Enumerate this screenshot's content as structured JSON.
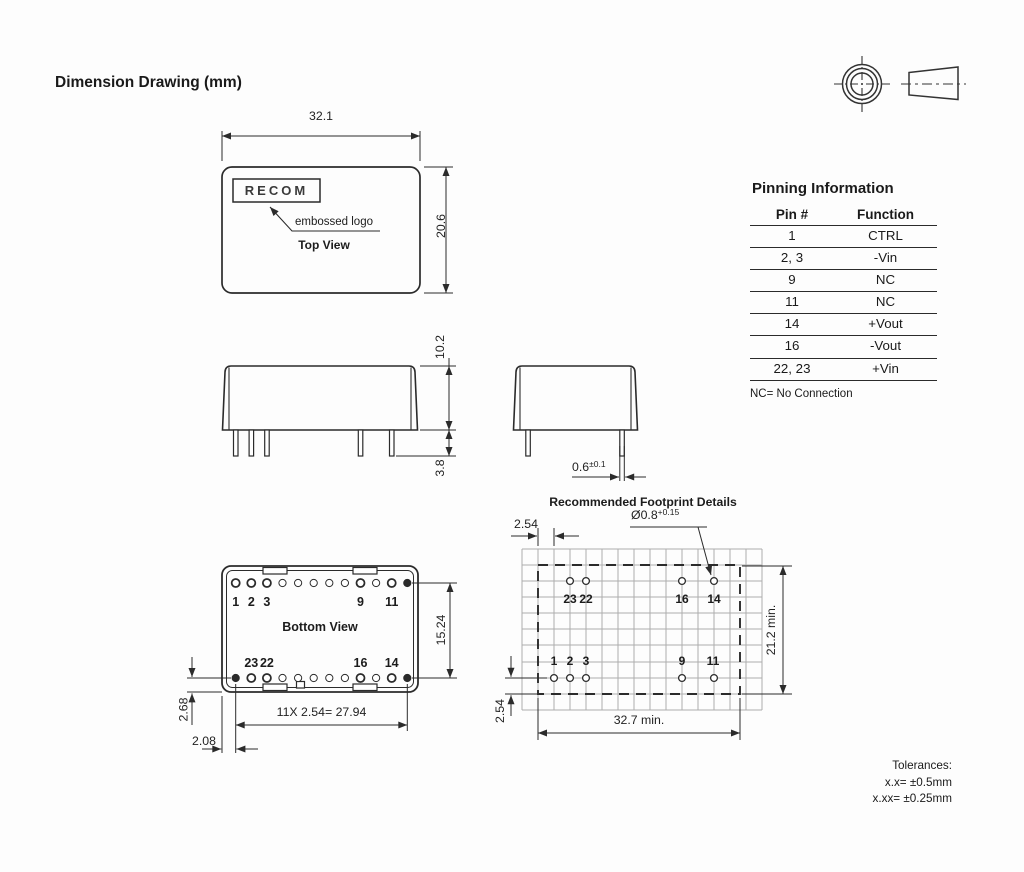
{
  "title": "Dimension Drawing (mm)",
  "top_view": {
    "logo": "RECOM",
    "annotation": "embossed logo",
    "label": "Top View",
    "width_dim": "32.1",
    "height_dim": "20.6"
  },
  "side_views": {
    "body_height_dim": "10.2",
    "pin_length_dim": "3.8",
    "pin_width_dim": "0.6",
    "pin_width_tol": "±0.1"
  },
  "bottom_view": {
    "label": "Bottom View",
    "top_pins": [
      "1",
      "2",
      "3",
      "9",
      "11"
    ],
    "bottom_pins": [
      "23",
      "22",
      "16",
      "14"
    ],
    "row_pitch_dim": "15.24",
    "pin_pitch_dim": "11X 2.54= 27.94",
    "row_edge_dim": "2.68",
    "col_edge_dim": "2.08"
  },
  "footprint": {
    "title": "Recommended Footprint Details",
    "grid_pitch_dim": "2.54",
    "hole_dia": "Ø0.8",
    "hole_tol": "+0.15",
    "top_pads": [
      "23",
      "22",
      "16",
      "14"
    ],
    "bottom_pads": [
      "1",
      "2",
      "3",
      "9",
      "11"
    ],
    "height_dim": "21.2 min.",
    "width_dim": "32.7 min.",
    "bottom_offset_dim": "2.54"
  },
  "pinning_table": {
    "title": "Pinning Information",
    "headers": [
      "Pin #",
      "Function"
    ],
    "rows": [
      [
        "1",
        "CTRL"
      ],
      [
        "2, 3",
        "-Vin"
      ],
      [
        "9",
        "NC"
      ],
      [
        "11",
        "NC"
      ],
      [
        "14",
        "+Vout"
      ],
      [
        "16",
        "-Vout"
      ],
      [
        "22, 23",
        "+Vin"
      ]
    ],
    "note": "NC= No Connection"
  },
  "tolerances": {
    "label": "Tolerances:",
    "x_x": "x.x= ±0.5mm",
    "x_xx": "x.xx= ±0.25mm"
  }
}
